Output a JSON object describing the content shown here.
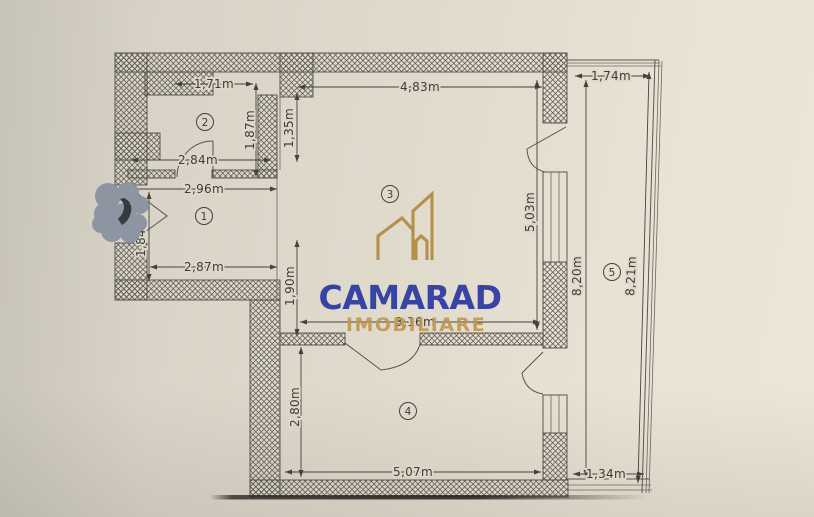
{
  "meta": {
    "document_kind": "apartment floor plan photo with agency watermark"
  },
  "watermark": {
    "brand": "CAMARAD",
    "subtitle": "IMOBILIARE"
  },
  "colors": {
    "brand_blue": "#2e3ca2",
    "brand_gold": "#c0954f",
    "paper": "#e0dbcd",
    "ink": "#45423b",
    "smudge_gray": "#8c95a1"
  },
  "rooms": [
    {
      "number": "1"
    },
    {
      "number": "2"
    },
    {
      "number": "3"
    },
    {
      "number": "4"
    },
    {
      "number": "5"
    }
  ],
  "dims": [
    {
      "label": "1,71m"
    },
    {
      "label": "1,87m"
    },
    {
      "label": "1,35m"
    },
    {
      "label": "2,84m"
    },
    {
      "label": "2,96m"
    },
    {
      "label": "1,84m"
    },
    {
      "label": "2,87m"
    },
    {
      "label": "1,90m"
    },
    {
      "label": "4,83m"
    },
    {
      "label": "5,03m"
    },
    {
      "label": "3,16m"
    },
    {
      "label": "2,80m"
    },
    {
      "label": "5,07m"
    },
    {
      "label": "1,74m"
    },
    {
      "label": "8,20m"
    },
    {
      "label": "8,21m"
    },
    {
      "label": "1,34m"
    }
  ]
}
